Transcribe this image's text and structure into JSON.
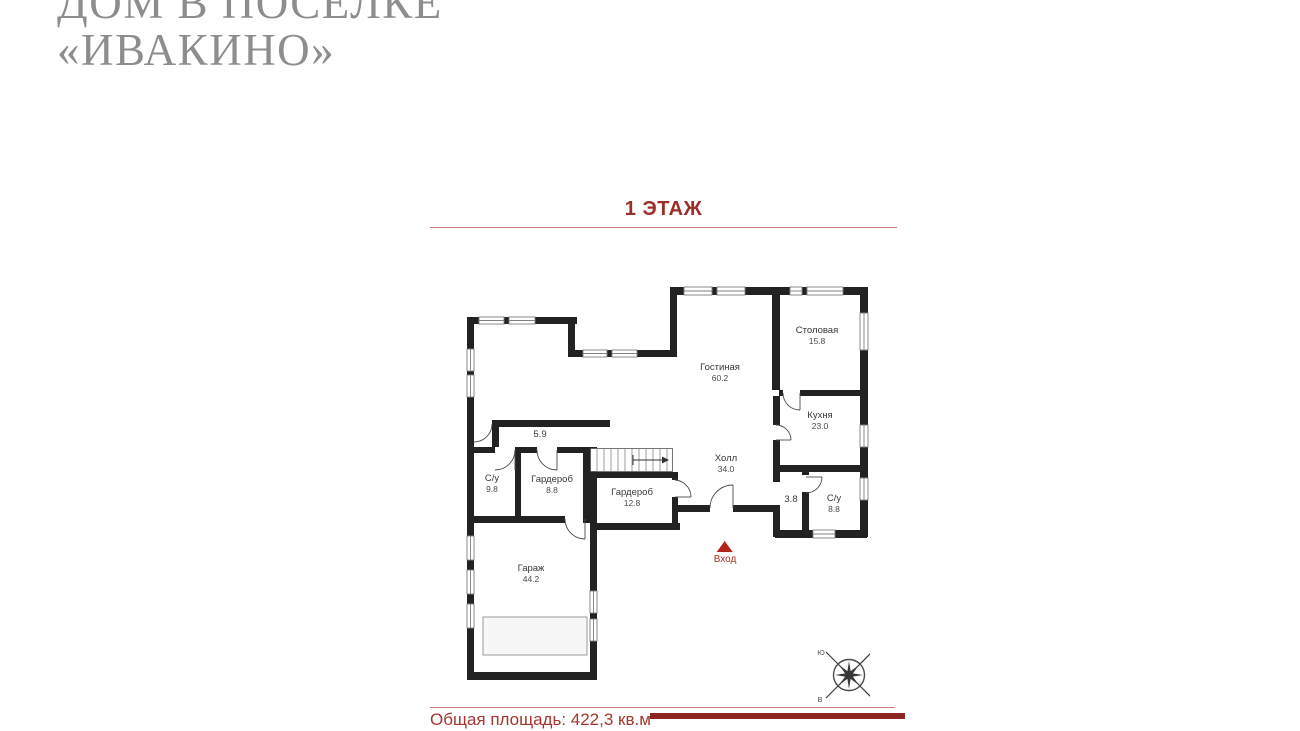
{
  "header": {
    "title_line1": "ДОМ В ПОСЕЛКЕ",
    "title_line2": "«ИВАКИНО»"
  },
  "floor_plan_page": {
    "floor_title": "1 ЭТАЖ",
    "total_area": "Общая площадь: 422,3 кв.м",
    "entrance_label": "Вход",
    "rooms": [
      {
        "name": "Гостиная",
        "area": "60.2"
      },
      {
        "name": "Столовая",
        "area": "15.8"
      },
      {
        "name": "Кухня",
        "area": "23.0"
      },
      {
        "name": "Холл",
        "area": "34.0"
      },
      {
        "name": "С/у",
        "area": "9.8"
      },
      {
        "name": "Гардероб",
        "area": "8.8"
      },
      {
        "name": "Гардероб",
        "area": "12.8"
      },
      {
        "name": "С/у",
        "area": "8.8"
      },
      {
        "name": "Гараж",
        "area": "44.2"
      },
      {
        "name": "",
        "area": "5.9"
      },
      {
        "name": "",
        "area": "3.8"
      }
    ],
    "compass": {
      "nw": "Ю",
      "ne": "З",
      "sw": "В",
      "se": "С"
    }
  },
  "colors": {
    "accent_red": "#9c2e27",
    "entrance_red": "#b3231a",
    "divider_red": "#c47d78",
    "wall_black": "#222222"
  }
}
